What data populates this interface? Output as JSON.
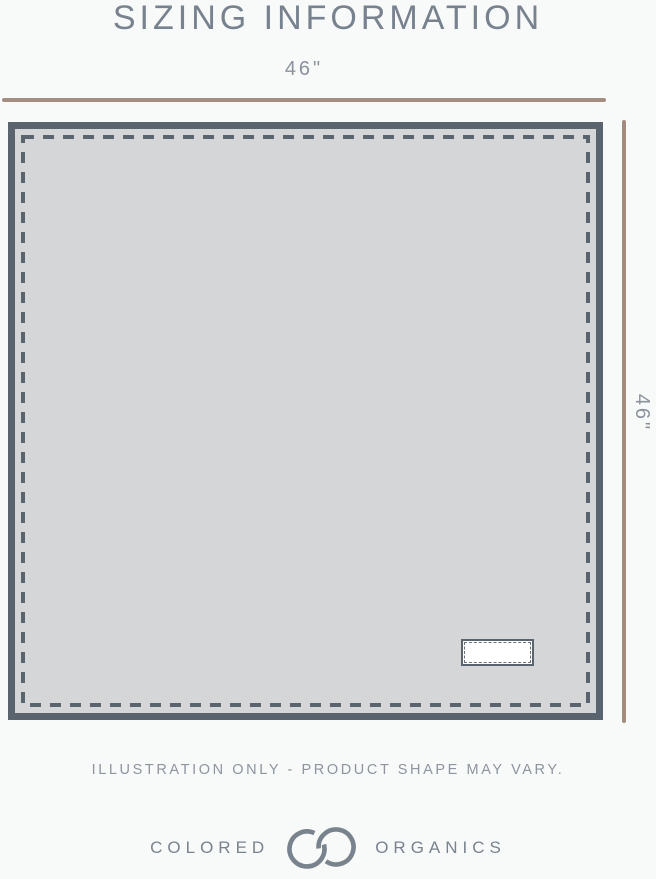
{
  "header": {
    "title": "SIZING INFORMATION"
  },
  "diagram": {
    "width_label": "46\"",
    "height_label": "46\"",
    "subject": "square blanket illustration with stitched edge and care tag"
  },
  "caption": "ILLUSTRATION ONLY - PRODUCT SHAPE MAY VARY.",
  "brand": {
    "word_left": "COLORED",
    "word_right": "ORGANICS",
    "monogram_icon": "interlocking-co-monogram"
  },
  "colors": {
    "background": "#f8f9f9",
    "title": "#78828e",
    "dimension_label": "#8b939c",
    "measure_line": "#a28d80",
    "blanket_fill": "#d4d6d8",
    "blanket_border": "#5a646e",
    "tag_fill": "#ffffff",
    "caption": "#8d959e",
    "logo": "#79838d"
  }
}
